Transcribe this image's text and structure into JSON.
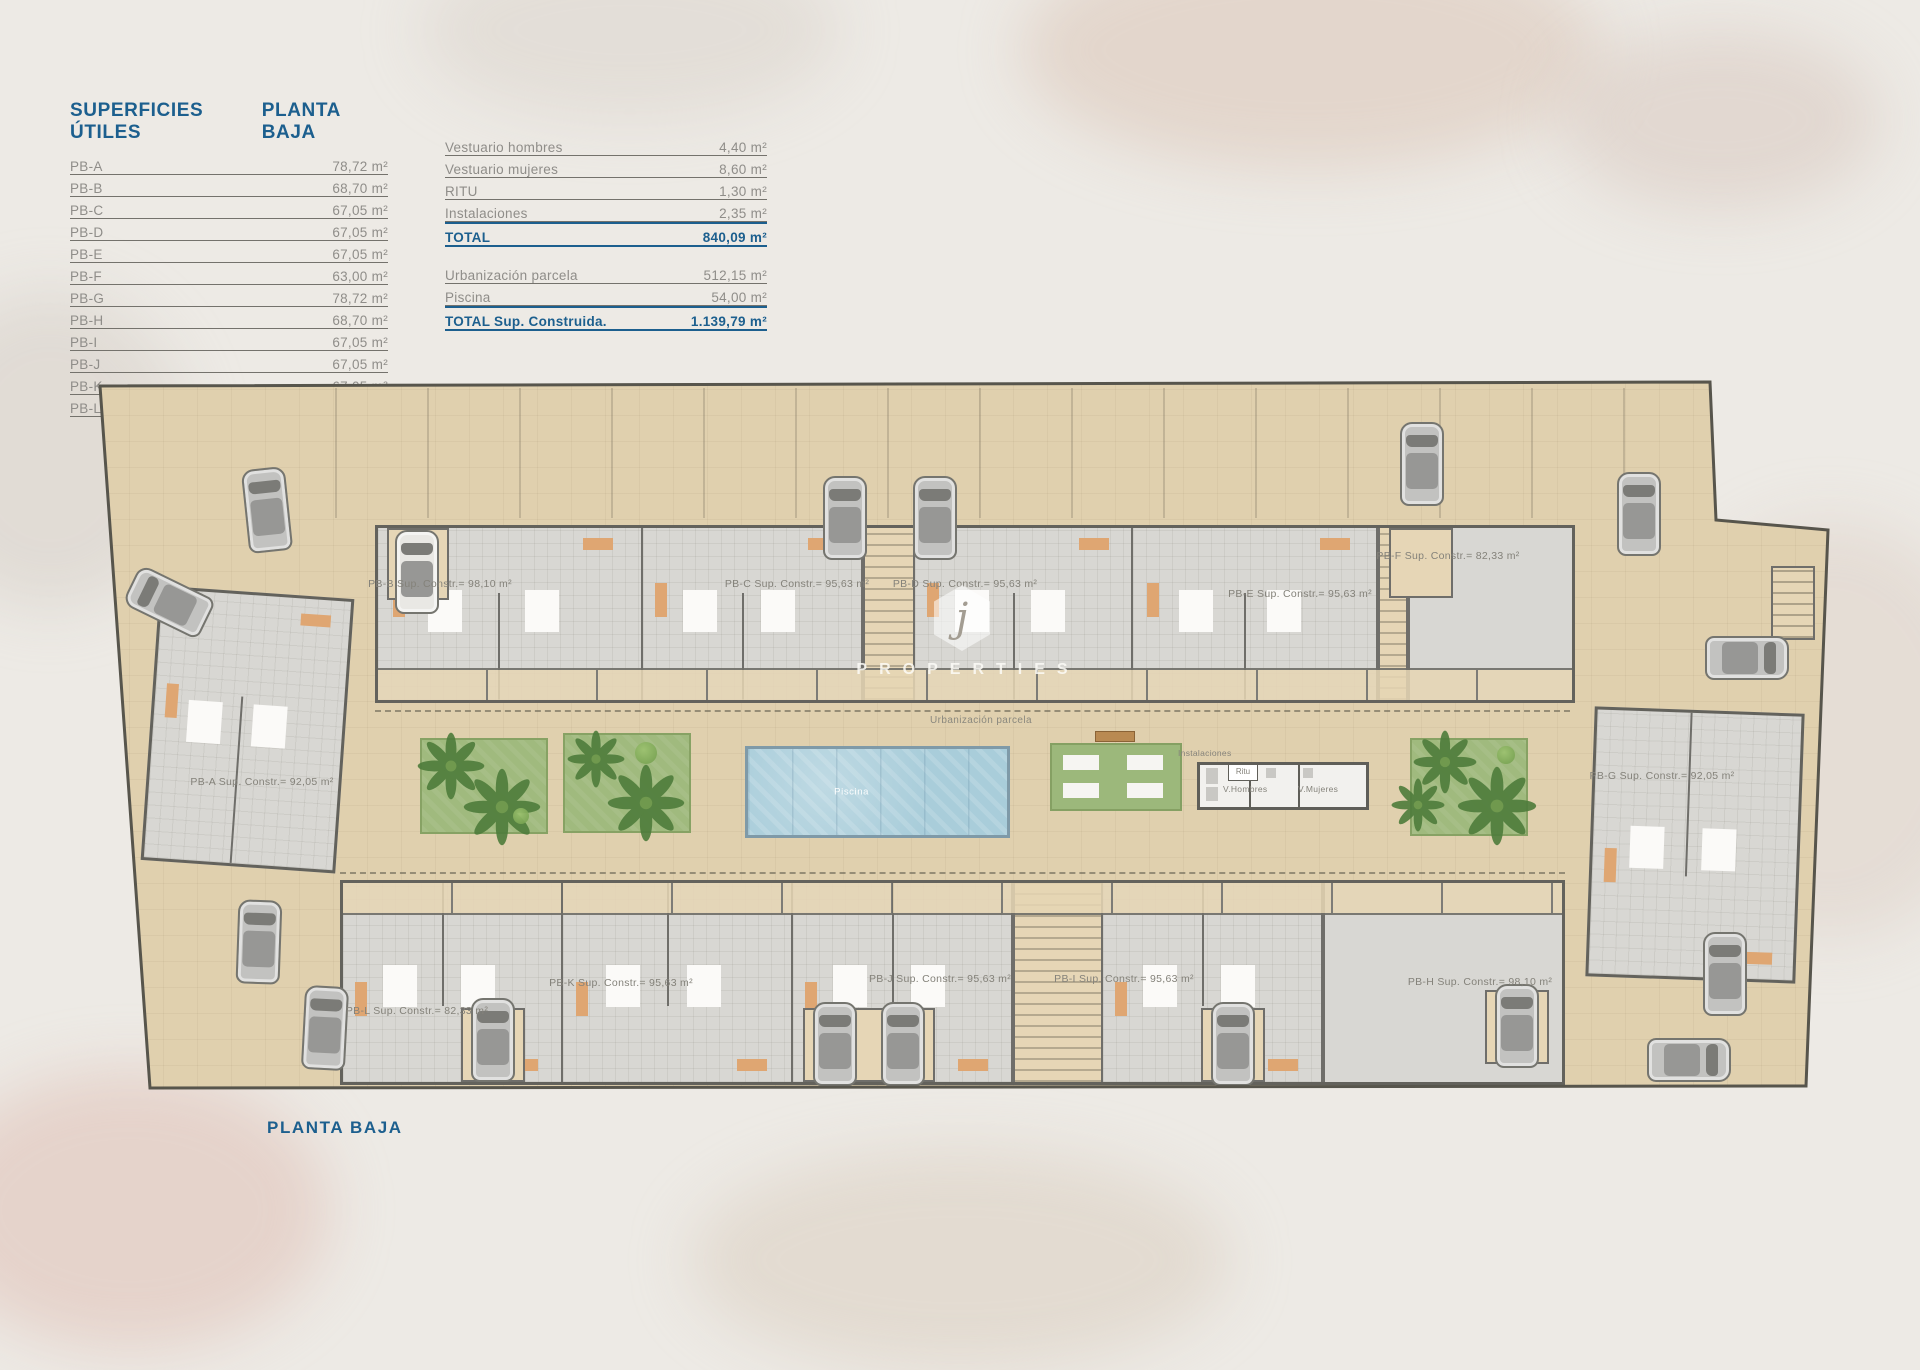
{
  "colors": {
    "accent_blue": "#1c5f8e",
    "text_gray": "#8f8d89",
    "parcel_beige": "#e0d0ae",
    "pool_blue": "#a9cdda",
    "garden_green": "#a0ba7e"
  },
  "superficies_table": {
    "title": "SUPERFICIES ÚTILES",
    "floor": "PLANTA BAJA",
    "rows": [
      {
        "label": "PB-A",
        "value": "78,72 m²"
      },
      {
        "label": "PB-B",
        "value": "68,70 m²"
      },
      {
        "label": "PB-C",
        "value": "67,05 m²"
      },
      {
        "label": "PB-D",
        "value": "67,05 m²"
      },
      {
        "label": "PB-E",
        "value": "67,05 m²"
      },
      {
        "label": "PB-F",
        "value": "63,00 m²"
      },
      {
        "label": "PB-G",
        "value": "78,72 m²"
      },
      {
        "label": "PB-H",
        "value": "68,70 m²"
      },
      {
        "label": "PB-I",
        "value": "67,05 m²"
      },
      {
        "label": "PB-J",
        "value": "67,05 m²"
      },
      {
        "label": "PB-K",
        "value": "67,05 m²"
      },
      {
        "label": "PB-L",
        "value": "63,30 m²"
      }
    ]
  },
  "summary_table": {
    "rows": [
      {
        "label": "Vestuario hombres",
        "value": "4,40 m²"
      },
      {
        "label": "Vestuario mujeres",
        "value": "8,60 m²"
      },
      {
        "label": "RITU",
        "value": "1,30 m²"
      },
      {
        "label": "Instalaciones",
        "value": "2,35 m²"
      }
    ],
    "total": {
      "label": "TOTAL",
      "value": "840,09 m²"
    },
    "rows2": [
      {
        "label": "Urbanización parcela",
        "value": "512,15 m²"
      },
      {
        "label": "Piscina",
        "value": "54,00 m²"
      }
    ],
    "total2": {
      "label": "TOTAL Sup. Construida.",
      "value": "1.139,79 m²"
    }
  },
  "plan": {
    "unit_labels": [
      {
        "id": "pb-a",
        "text": "PB-A Sup. Constr.= 92,05 m²"
      },
      {
        "id": "pb-b",
        "text": "PB-B Sup. Constr.= 98,10 m²"
      },
      {
        "id": "pb-c",
        "text": "PB-C Sup. Constr.= 95,63 m²"
      },
      {
        "id": "pb-d",
        "text": "PB-D Sup. Constr.= 95,63 m²"
      },
      {
        "id": "pb-e",
        "text": "PB-E Sup. Constr.= 95,63 m²"
      },
      {
        "id": "pb-f",
        "text": "PB-F Sup. Constr.= 82,33 m²"
      },
      {
        "id": "pb-g",
        "text": "PB-G Sup. Constr.= 92,05 m²"
      },
      {
        "id": "pb-h",
        "text": "PB-H Sup. Constr.= 98,10 m²"
      },
      {
        "id": "pb-i",
        "text": "PB-I Sup. Constr.= 95,63 m²"
      },
      {
        "id": "pb-j",
        "text": "PB-J Sup. Constr.= 95,63 m²"
      },
      {
        "id": "pb-k",
        "text": "PB-K Sup. Constr.= 95,63 m²"
      },
      {
        "id": "pb-l",
        "text": "PB-L Sup. Constr.= 82,33 m²"
      }
    ],
    "annotations": {
      "urbanizacion": "Urbanización parcela",
      "piscina": "Piscina",
      "instalaciones": "Instalaciones",
      "ritu": "Ritu",
      "v_hombres": "V.Hombres",
      "v_mujeres": "V.Mujeres"
    }
  },
  "watermark": {
    "initial": "j",
    "text": "PROPERTIES"
  },
  "footer_label": "PLANTA BAJA"
}
